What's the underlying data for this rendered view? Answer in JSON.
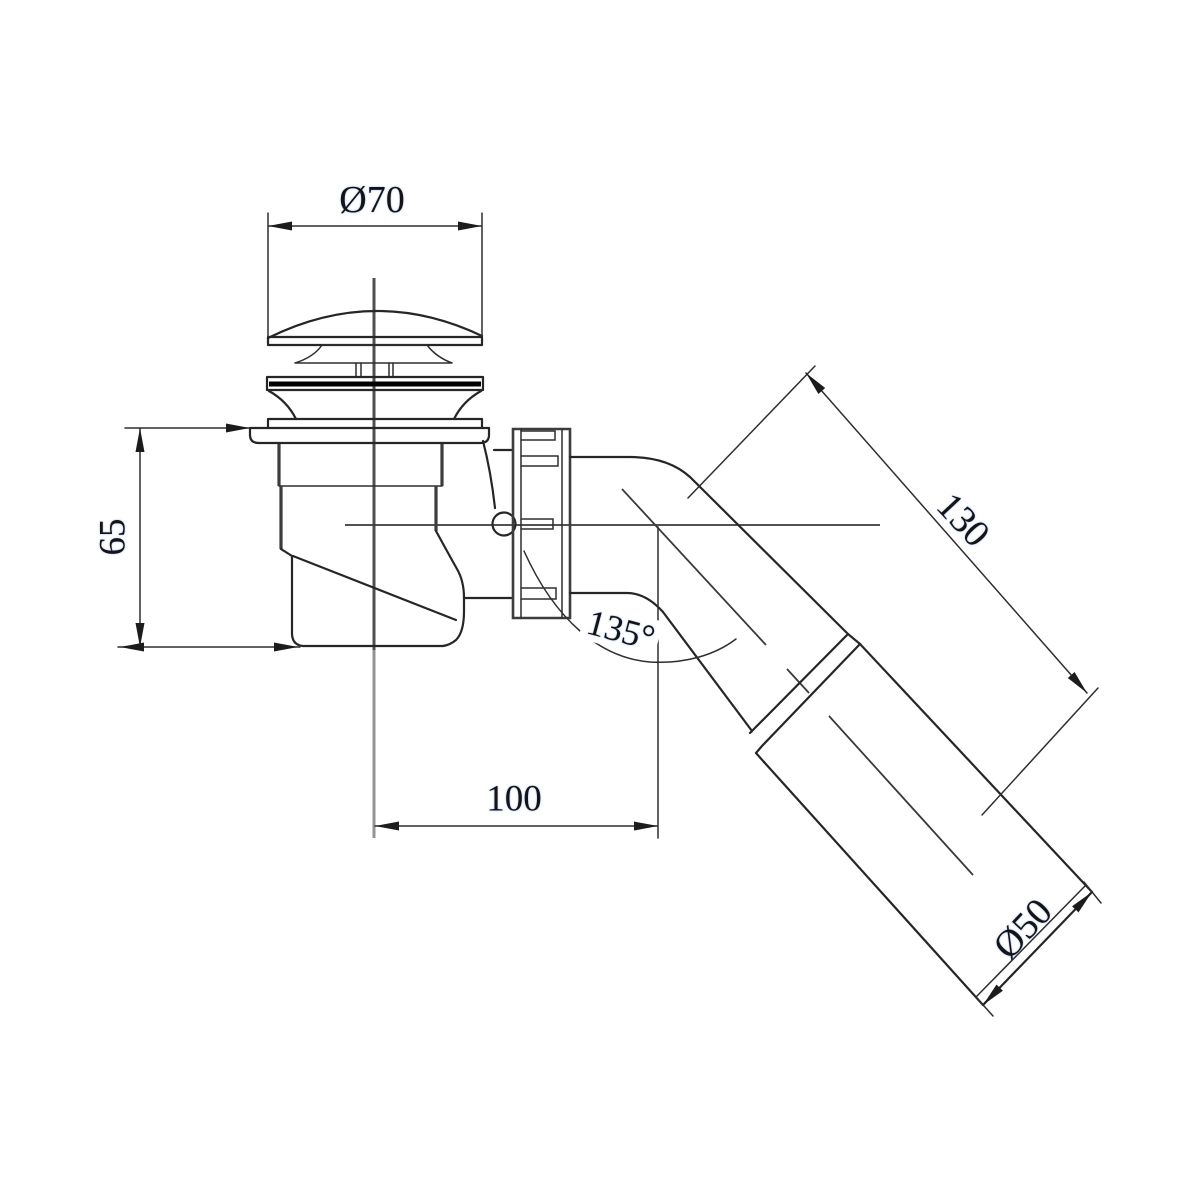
{
  "page": {
    "type": "technical-drawing",
    "background": "#ffffff"
  },
  "drawing": {
    "subject": "Bath waste drain with click-clack plug, coupling nut and angled outlet pipe",
    "labels": {
      "cap_diameter": "Ø70",
      "trap_height": "65",
      "horizontal_length": "100",
      "outlet_angle": "135°",
      "outlet_pipe_length": "130",
      "outlet_pipe_diameter": "Ø50"
    },
    "colors": {
      "line": "#2b2b2b",
      "centerline": "#707070",
      "text": "#141414",
      "background": "#ffffff"
    }
  }
}
